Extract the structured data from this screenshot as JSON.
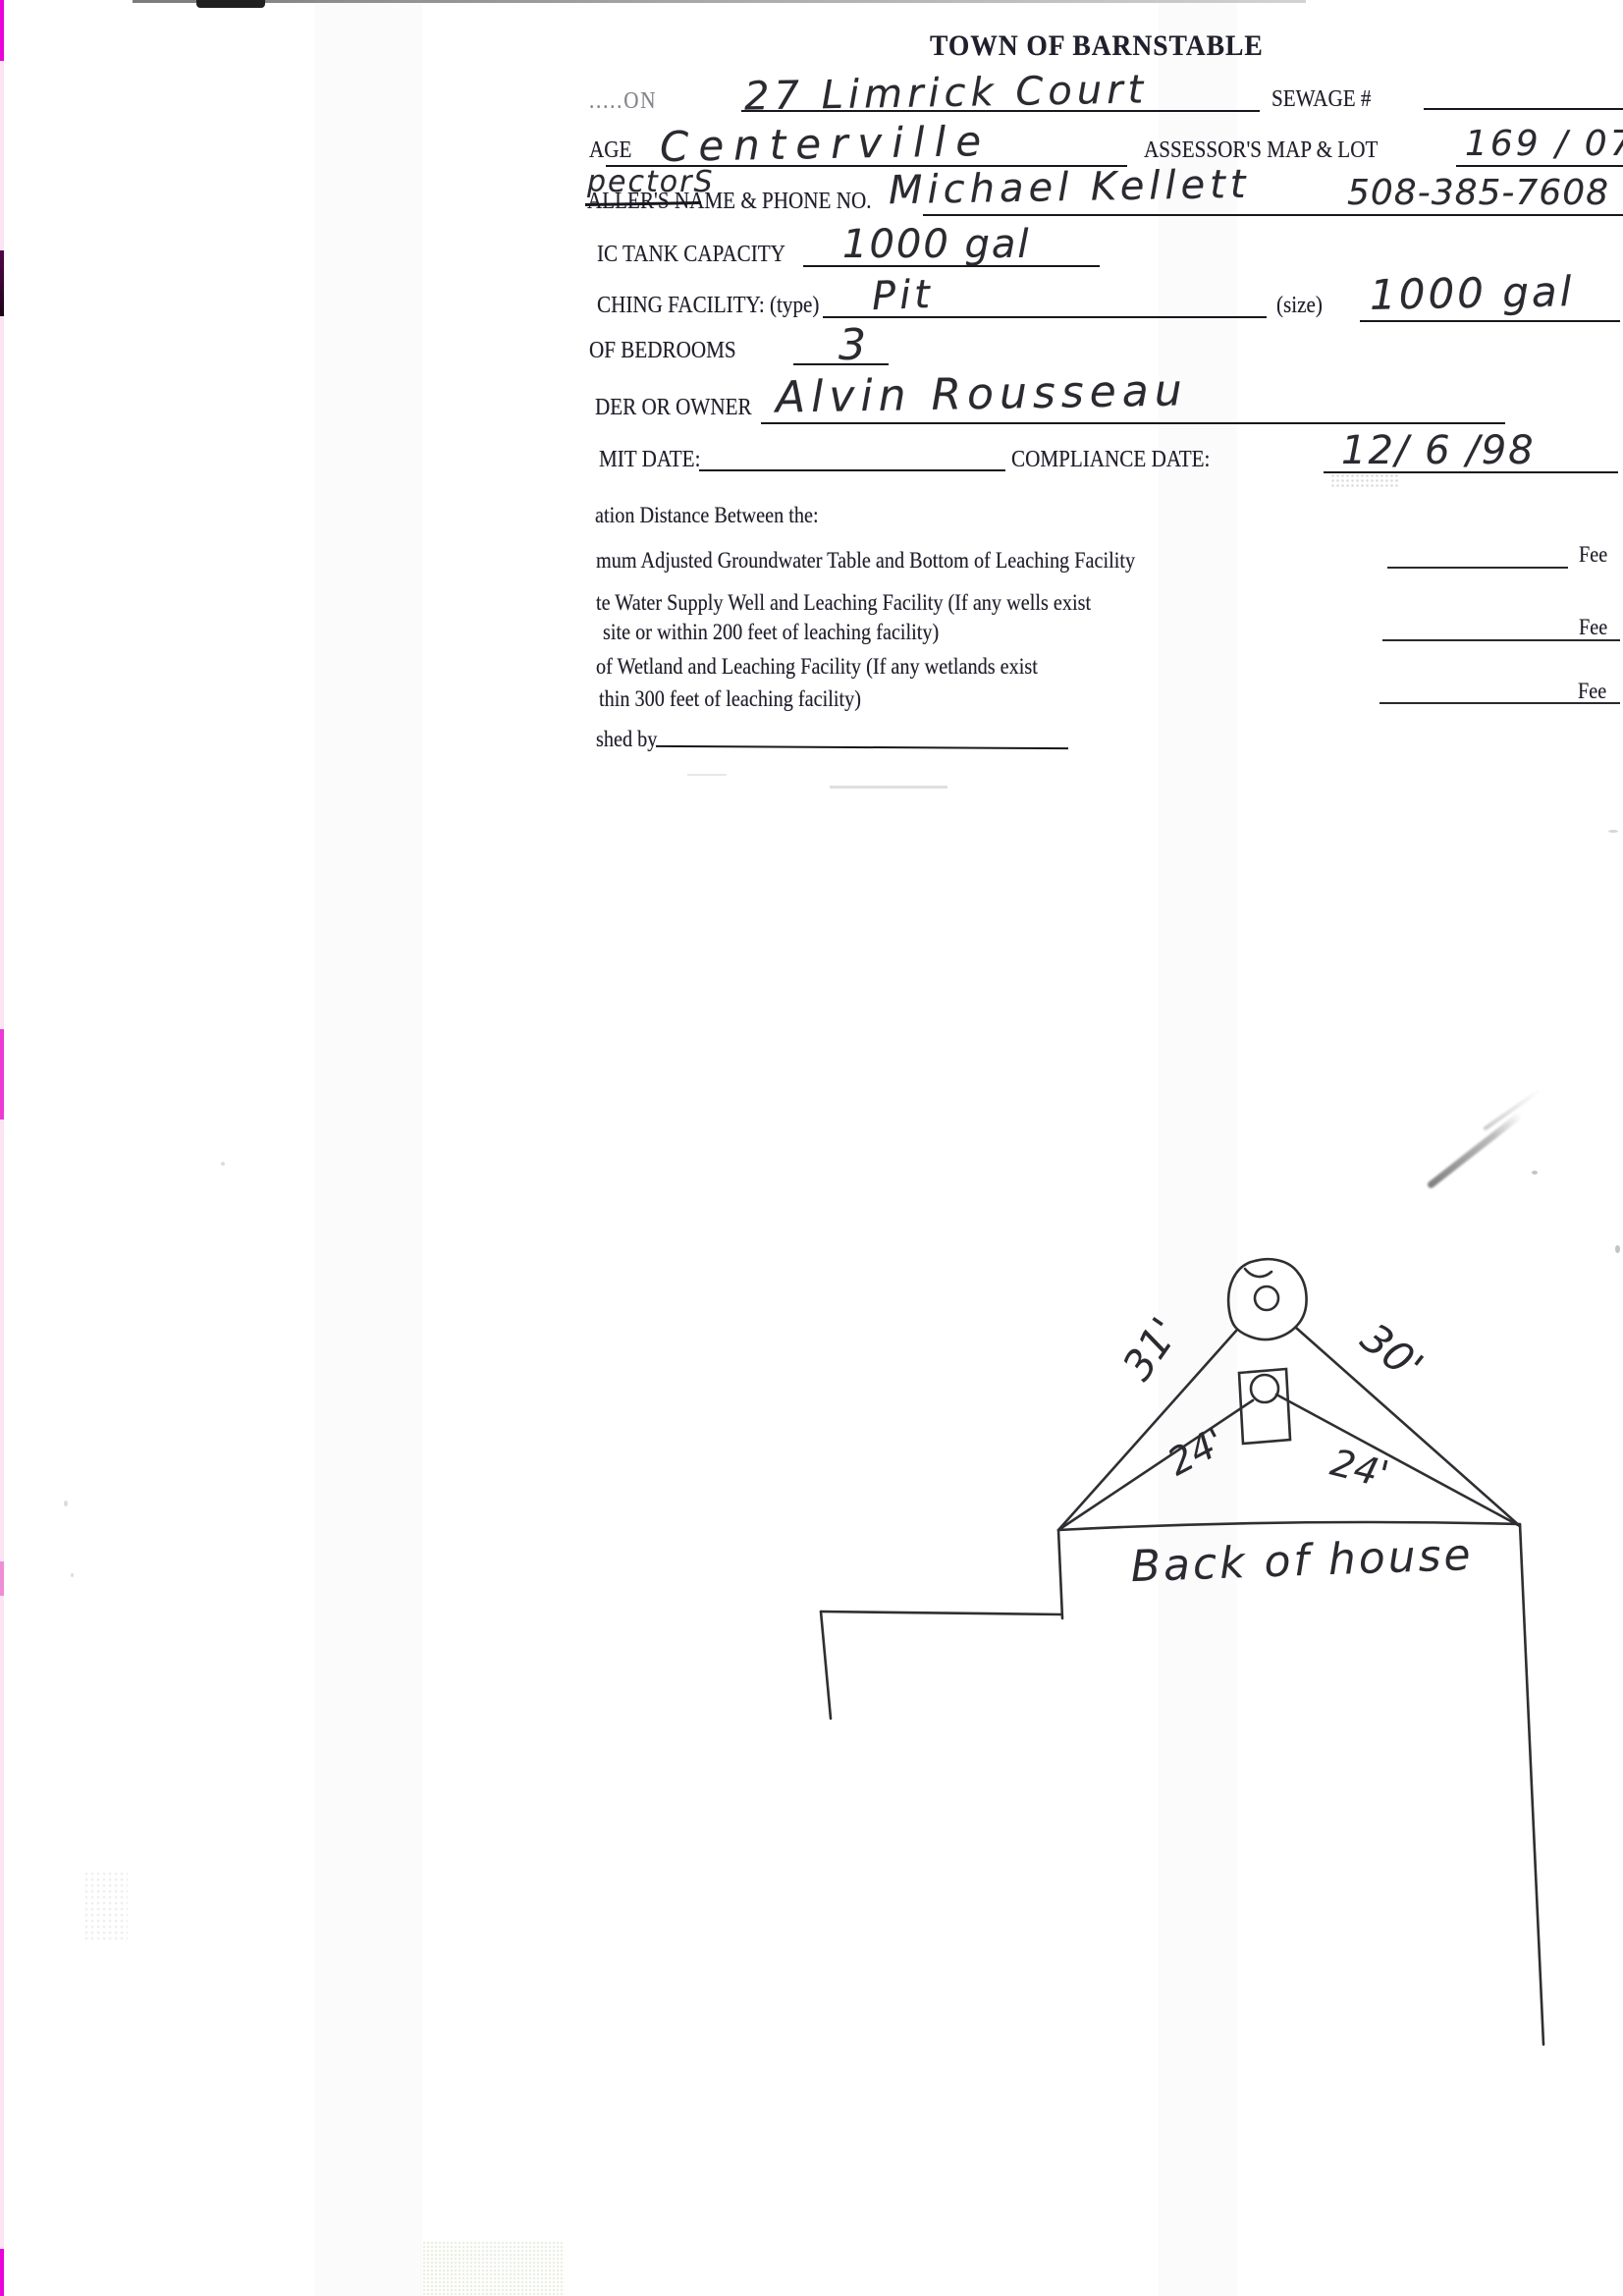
{
  "document": {
    "title": "TOWN OF BARNSTABLE",
    "fields": {
      "location": {
        "label_truncated": ".....ON",
        "value": "27 Limrick Court"
      },
      "sewage": {
        "label": "SEWAGE #",
        "value": ""
      },
      "village": {
        "label_truncated": "AGE",
        "value": "Centerville"
      },
      "assessors_map_lot": {
        "label": "ASSESSOR'S MAP & LOT",
        "value": "169 / 078"
      },
      "installer": {
        "handwritten_correction": "pectorS",
        "label_truncated": "ALLER'S NAME & PHONE NO.",
        "name_value": "Michael Kellett",
        "phone_value": "508-385-7608"
      },
      "septic_tank_capacity": {
        "label_truncated": "IC TANK CAPACITY",
        "value": "1000 gal"
      },
      "leaching_facility": {
        "label_truncated": "CHING FACILITY: (type)",
        "type_value": "Pit",
        "size_label": "(size)",
        "size_value": "1000 gal"
      },
      "bedrooms": {
        "label_truncated": "OF BEDROOMS",
        "value": "3"
      },
      "builder_or_owner": {
        "label_truncated": "DER OR OWNER",
        "value": "Alvin Rousseau"
      },
      "permit_date": {
        "label_truncated": "MIT DATE:",
        "value": ""
      },
      "compliance_date": {
        "label": "COMPLIANCE DATE:",
        "value": "12/ 6 /98"
      }
    },
    "separation": {
      "heading_truncated": "ation Distance Between the:",
      "rows": [
        {
          "text": "mum Adjusted Groundwater Table and Bottom of Leaching Facility",
          "text2": "",
          "unit": "Fee"
        },
        {
          "text": "te Water Supply Well and Leaching Facility  (If any wells exist",
          "text2": "site or within 200 feet of leaching facility)",
          "unit": "Fee"
        },
        {
          "text": "of Wetland and Leaching Facility (If any wetlands exist",
          "text2": "thin 300 feet of leaching facility)",
          "unit": "Fee"
        }
      ],
      "footer_truncated": "shed by"
    },
    "diagram": {
      "caption": "Back of house",
      "labels": {
        "left_pit": "31'",
        "right_pit": "30'",
        "left_tank": "24'",
        "right_tank": "24'"
      }
    }
  },
  "colors": {
    "ink": "#1e1e28",
    "pen": "#2a2a30",
    "edge_magenta": "#e705da"
  }
}
